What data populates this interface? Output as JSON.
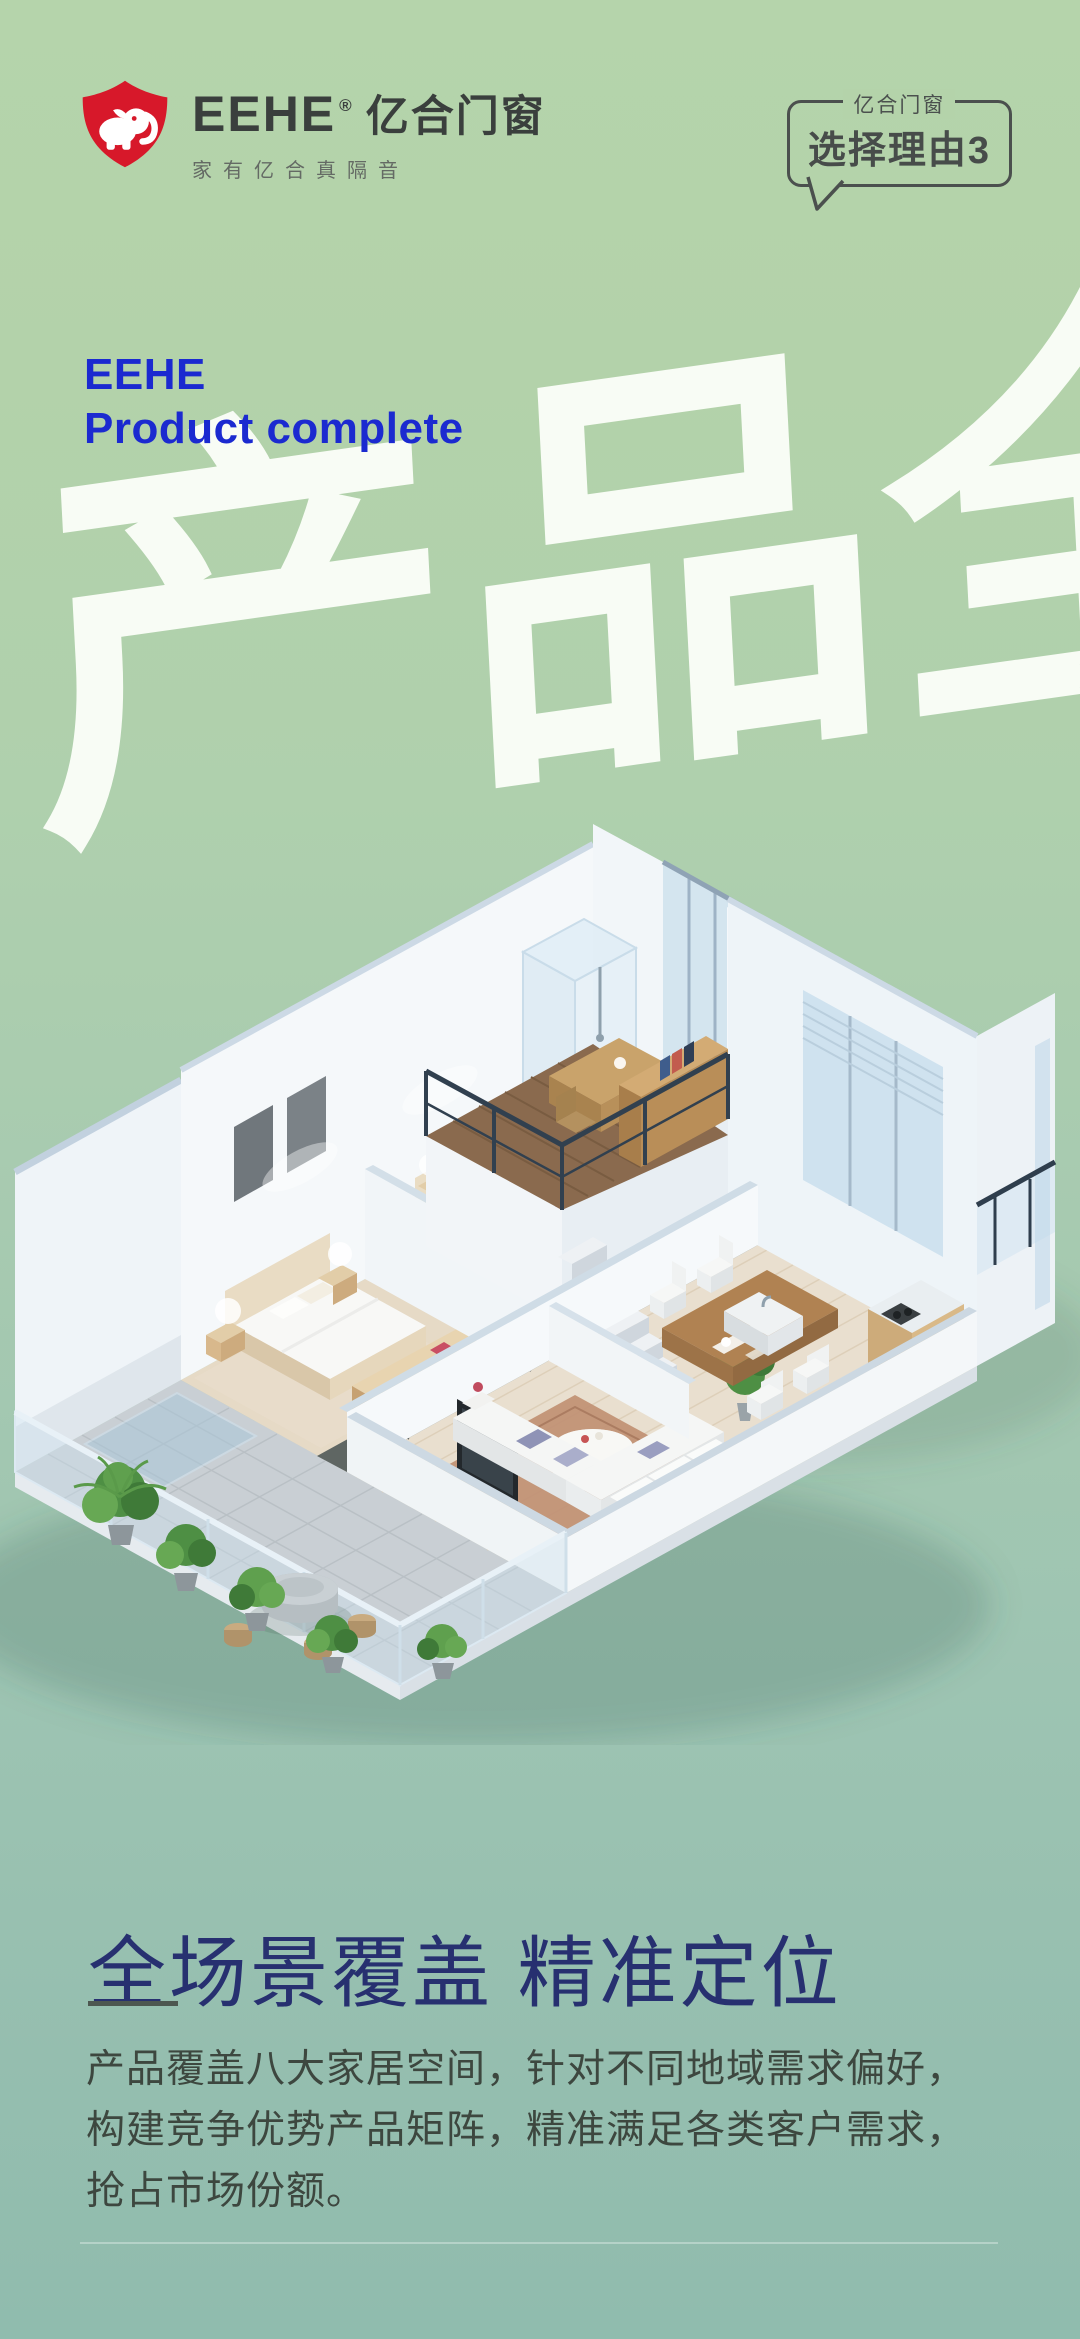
{
  "brand": {
    "name": "EEHE",
    "registered": "®",
    "name_cn": "亿合门窗",
    "tagline": "家有亿合真隔音",
    "logo_icon": "shield-elephant",
    "logo_red": "#d7182a"
  },
  "badge": {
    "label": "亿合门窗",
    "title": "选择理由3"
  },
  "hero": {
    "en_line1": "EEHE",
    "en_line2": "Product complete",
    "headline_cn": "产品全"
  },
  "illustration": {
    "name": "isometric-apartment-cutaway",
    "rooms": [
      "terrace-garden",
      "living-room",
      "dining-room",
      "kitchen",
      "bedroom",
      "master-bedroom",
      "bathroom",
      "loft-study"
    ]
  },
  "section": {
    "title": "全场景覆盖 精准定位",
    "body_lines": [
      "产品覆盖八大家居空间，针对不同地域需求偏好，",
      "构建竞争优势产品矩阵，精准满足各类客户需求，",
      "抢占市场份额。"
    ]
  },
  "colors": {
    "background_top": "#b5d4ab",
    "background_bottom": "#90bcae",
    "hero_blue": "#1b2ad0",
    "title_navy": "#273070",
    "body_text": "#3d473f",
    "headline_white": "#fbfef8",
    "logo_red": "#d7182a",
    "divider_dark": "#4d5750"
  }
}
